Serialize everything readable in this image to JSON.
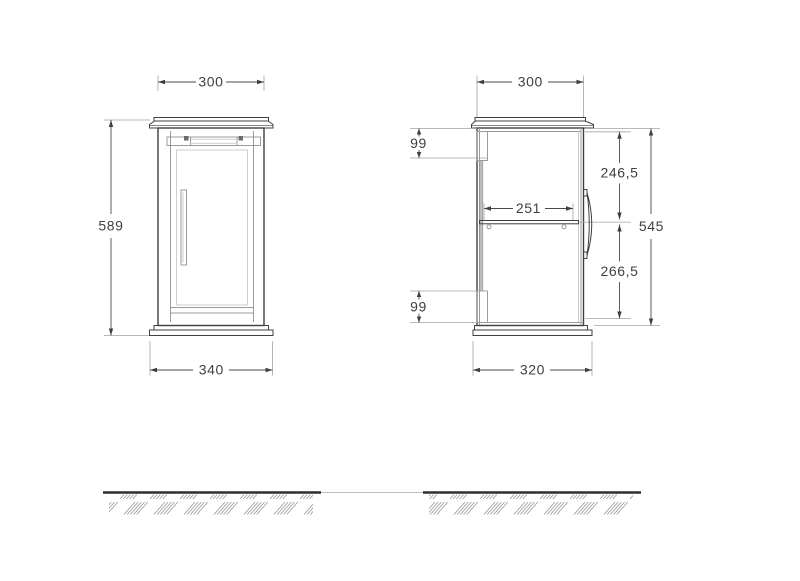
{
  "drawing": {
    "title": "wall-cabinet-dimension-drawing",
    "front_view": {
      "dim_width_top": "300",
      "dim_height": "589",
      "dim_width_bottom": "340"
    },
    "side_view": {
      "dim_depth_top": "300",
      "dim_hinge_top": "99",
      "dim_top_to_shelf": "246,5",
      "dim_shelf_depth": "251",
      "dim_carcass_height": "545",
      "dim_shelf_to_bottom": "266,5",
      "dim_hinge_bottom": "99",
      "dim_depth_bottom": "320"
    },
    "colors": {
      "line_dark": "#3f3f3f",
      "line_gray": "#9b9b9b",
      "line_light": "#c8c8c8",
      "dimension": "#4a4a4a",
      "extension": "#a3a3a3",
      "ground": "#2e2e2e",
      "hatch": "#979797",
      "background": "#ffffff"
    }
  }
}
